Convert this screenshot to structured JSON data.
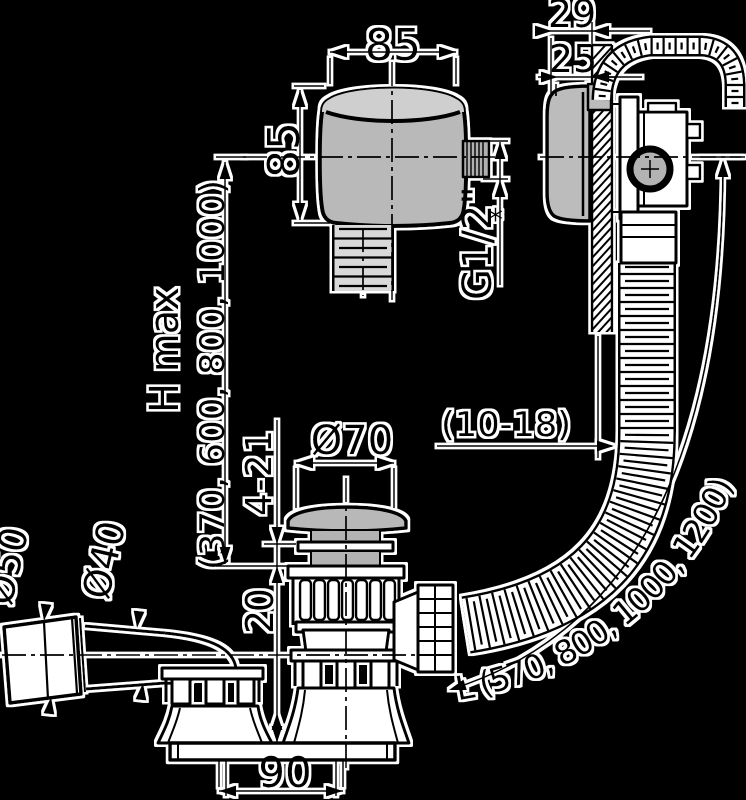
{
  "page": {
    "background": "#000000"
  },
  "drawing": {
    "type": "technical-diagram",
    "subject": "bath waste and overflow set",
    "labels": {
      "width_top": "85",
      "height_left": "85",
      "thread_size": "G1/2\"",
      "footnote_mark": "*",
      "depth_total": "29",
      "depth_recess": "25",
      "height_max_label": "H max",
      "height_max_values": "(370, 600, 800, 1000)",
      "plug_diameter": "Ø70",
      "plug_stroke_range": "4-21",
      "panel_thickness_range": "(10-18)",
      "outlet_offset": "20",
      "elbow_outer_diameter": "Ø50",
      "elbow_inner_diameter": "Ø40",
      "flange_diameter": "90",
      "hose_length": "L (570, 800, 1000, 1200)"
    },
    "colors": {
      "background": "#000000",
      "line": "#000000",
      "halo": "#ffffff",
      "fill_light": "#bcbcbc",
      "fill_lighter": "#cfcfcf",
      "fill_mid": "#b3b3b3",
      "hose_inner": "#ffffff",
      "tail_inner": "#d9d9d9"
    }
  }
}
